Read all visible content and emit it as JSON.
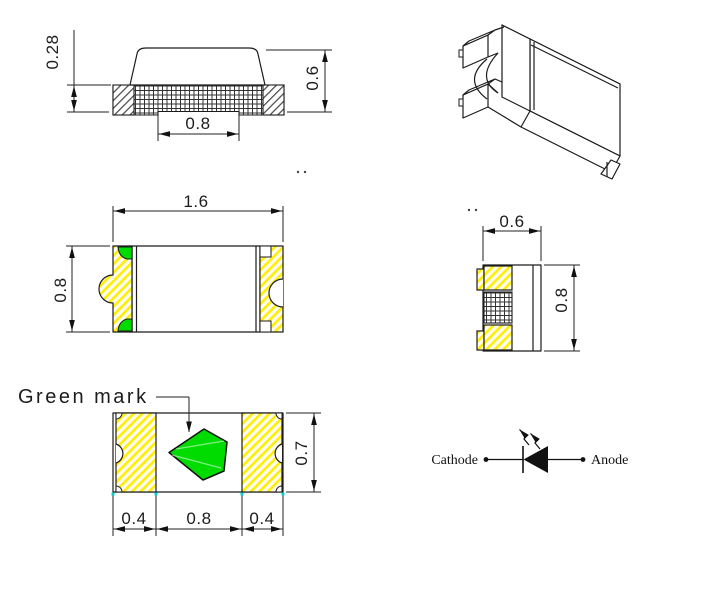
{
  "drawing": {
    "type": "SMD LED package outline drawing",
    "side_view": {
      "base_thickness": "0.28",
      "height": "0.6",
      "bottom_notch_width": "0.8"
    },
    "top_view": {
      "length": "1.6",
      "width": "0.8"
    },
    "end_view": {
      "width": "0.6",
      "height": "0.8"
    },
    "bottom_view": {
      "annotation": "Green mark",
      "left_pad": "0.4",
      "center": "0.8",
      "right_pad": "0.4",
      "width": "0.7"
    },
    "polarity_symbol": {
      "left_label": "Cathode",
      "right_label": "Anode"
    }
  },
  "colors": {
    "green": "#00dc00",
    "yellow": "#ffee00",
    "line": "#1c1c1c",
    "cyan": "#00d5d5"
  }
}
